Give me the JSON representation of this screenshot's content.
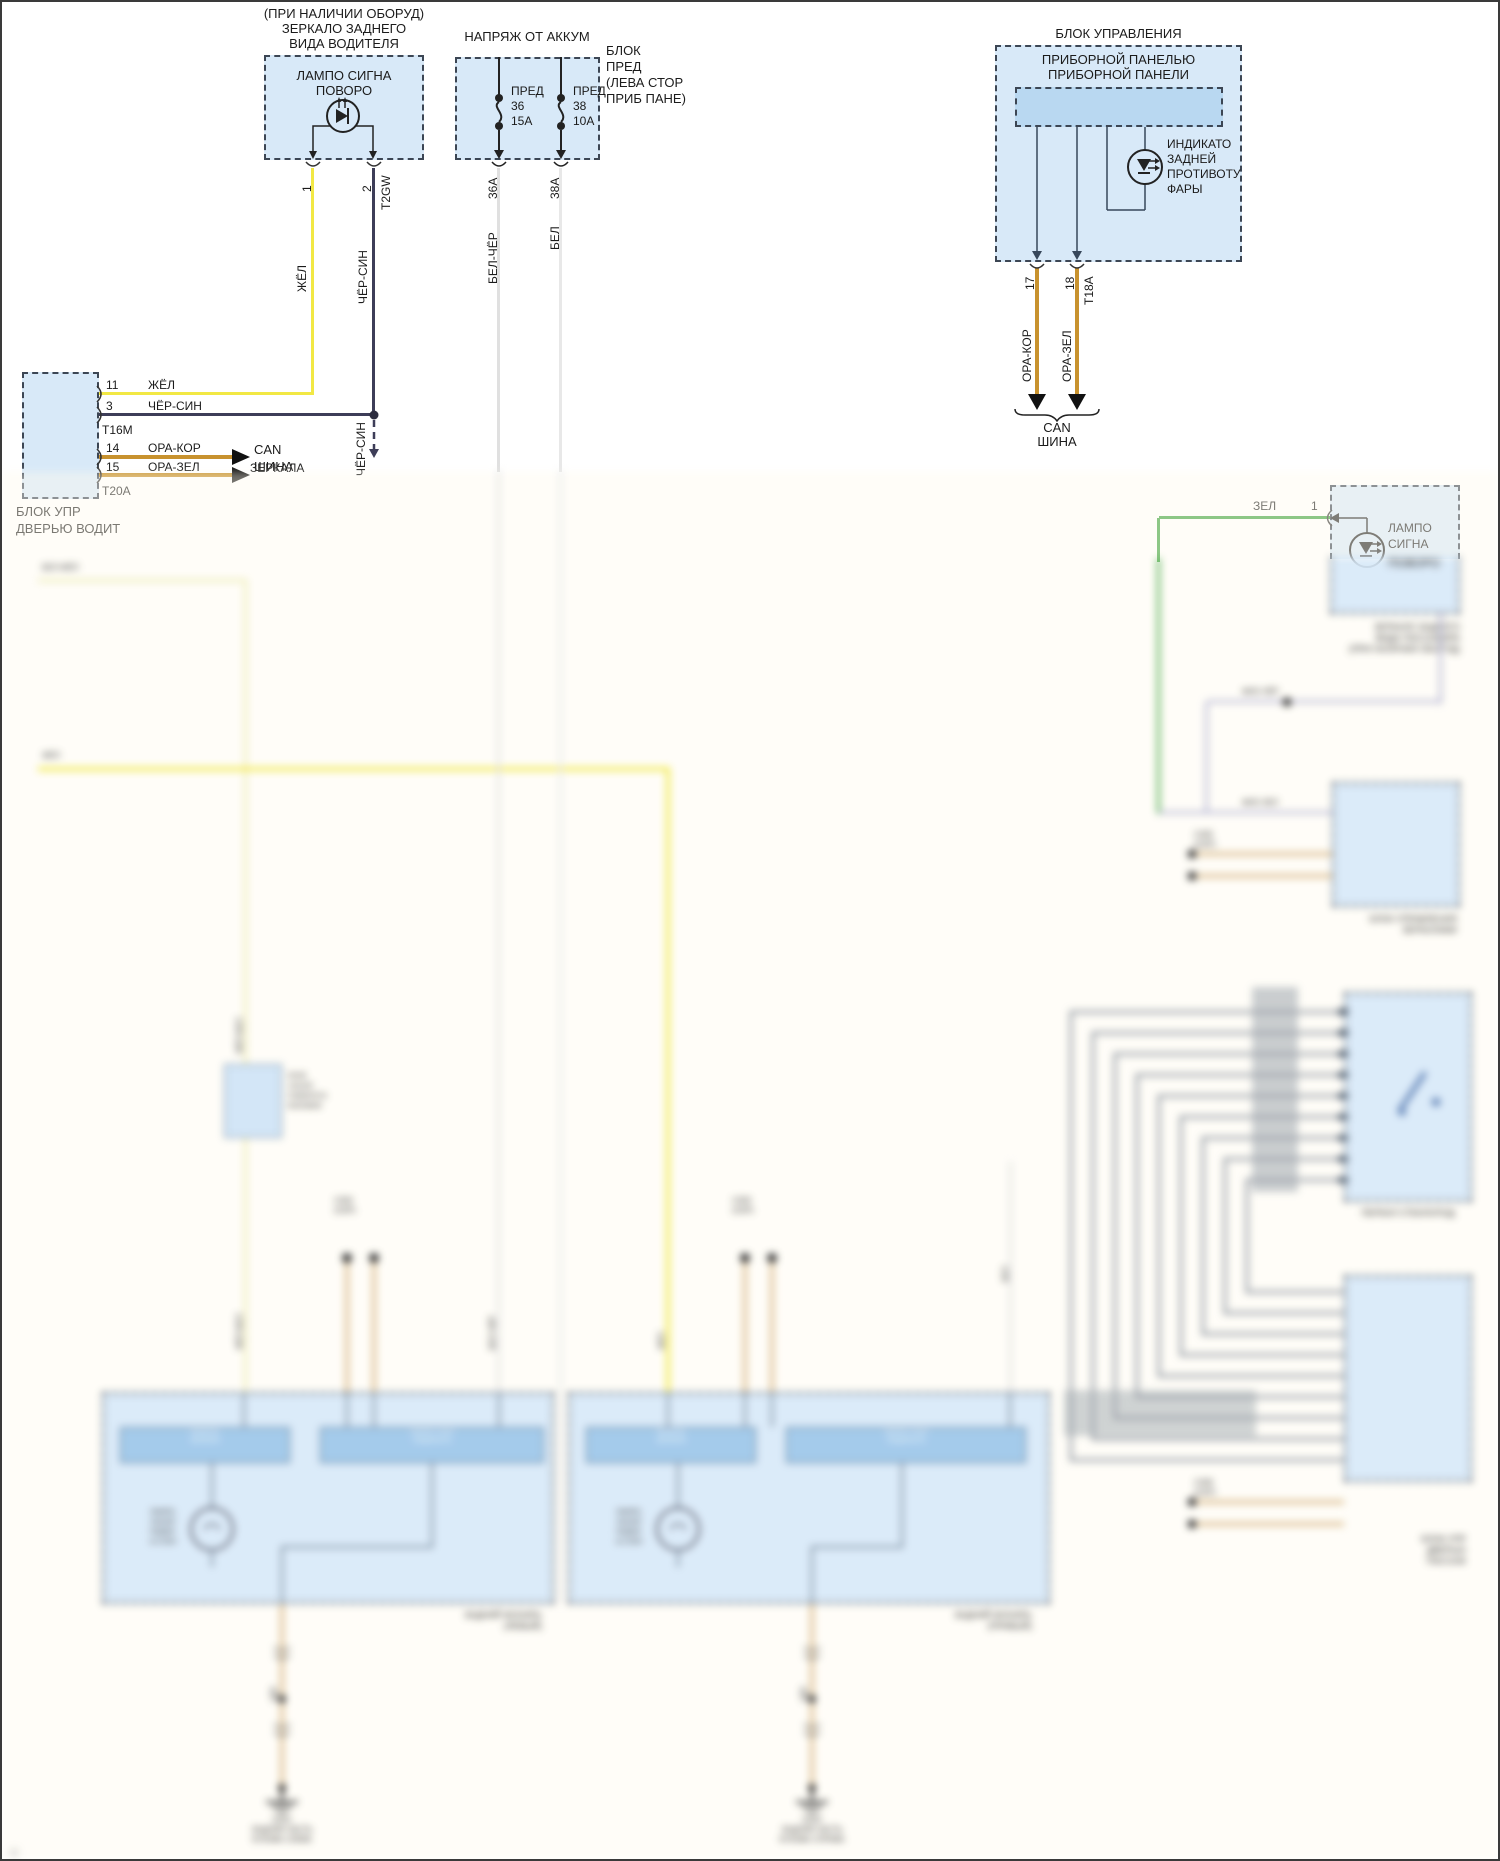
{
  "colors": {
    "module_fill": "#d8e9f8",
    "inner_fill": "#b9d8f1",
    "wire_yellow": "#f2e844",
    "wire_black_blue": "#3d3d58",
    "wire_orange": "#c8922e",
    "wire_white": "#e0e0e0",
    "wire_green": "#3da33d",
    "wire_lavender": "#b4b4d2",
    "wire_tan": "#d9ba8a",
    "wire_gray": "#9aa0a8"
  },
  "top_left_mirror": {
    "caption": [
      "(ПРИ НАЛИЧИИ ОБОРУД)",
      "ЗЕРКАЛО ЗАДНЕГО",
      "ВИДА ВОДИТЕЛЯ"
    ],
    "lamp": [
      "ЛАМПО СИГНА",
      "ПОВОРО"
    ],
    "pin_1": "1",
    "pin_2": "2",
    "connector": "T2GW",
    "wire_yellow": "ЖЁЛ",
    "wire_dark": "ЧЁР-СИН",
    "wire_dark_lower": "ЧЁР-СИН",
    "to_mirror": "ЗЕРКАЛА"
  },
  "driver_door_module": {
    "rows": [
      {
        "pin": "11",
        "wire": "ЖЁЛ"
      },
      {
        "pin": "3",
        "wire": "ЧЁР-СИН"
      },
      {
        "pin": "14",
        "wire": "ОРА-КОР"
      },
      {
        "pin": "15",
        "wire": "ОРА-ЗЕЛ"
      }
    ],
    "connector_top": "Т16М",
    "connector_bottom": "Т20А",
    "can_line1": "CAN",
    "can_line2": "ШИНА",
    "name_line1": "БЛОК УПР",
    "name_line2": "ДВЕРЬЮ ВОДИТ"
  },
  "fuse_box": {
    "title": "НАПРЯЖ ОТ АККУМ",
    "side_note": [
      "БЛОК",
      "ПРЕД",
      "(ЛЕВА СТОР",
      "ПРИБ ПАНЕ)"
    ],
    "fuses": [
      {
        "label": "ПРЕД",
        "number": "36",
        "rating": "15А",
        "pin": "36А",
        "wire_color": "БЕЛ-ЧЁР"
      },
      {
        "label": "ПРЕД",
        "number": "38",
        "rating": "10А",
        "pin": "38А",
        "wire_color": "БЕЛ"
      }
    ]
  },
  "instrument_cluster": {
    "title": "БЛОК УПРАВЛЕНИЯ",
    "subtitle": [
      "ПРИБОРНОЙ ПАНЕЛЬЮ",
      "ПРИБОРНОЙ ПАНЕЛИ"
    ],
    "indicator": [
      "ИНДИКАТО",
      "ЗАДНЕЙ",
      "ПРОТИВОТУ",
      "ФАРЫ"
    ],
    "pin_17": "17",
    "pin_18": "18",
    "connector": "Т18А",
    "wire_17": "ОРА-КОР",
    "wire_18": "ОРА-ЗЕЛ",
    "can_line1": "CAN",
    "can_line2": "ШИНА"
  },
  "passenger_mirror": {
    "wire_green": "ЗЕЛ",
    "pin": "1",
    "lamp_line1": "ЛАМПО",
    "lamp_line2": "СИГНА"
  },
  "blurred_section": {
    "wire1_label": "БЕЛ-ЖЁЛ",
    "wire2_label": "ЖЁЛ",
    "relay_label": [
      "РЕЛЕ",
      "УКАЗАТ",
      "ПОВОРОТА",
      "БОКОВОЕ"
    ],
    "wire_labels": {
      "w1": "ЖЁЛ-БЕЛ",
      "w2": "БЕЛ-ЧЁР",
      "w3": "ЖЁЛ",
      "w4": "БЕЛ"
    },
    "conn_left": [
      "С302",
      "(СЕР)"
    ],
    "conn_right": [
      "С303",
      "(СЕР)"
    ],
    "rear_lamp_left": {
      "bar1": [
        "МОДУЛЬ",
        "ФОНАРЯ"
      ],
      "bar2": [
        "ЛАМПА УКАЗ",
        "ПОВОРОТА"
      ],
      "side": [
        "ЛАМПА",
        "УКАЗАТ",
        "ПОВОР",
        "И СТОП"
      ],
      "name": [
        "ЗАДНИЙ ФОНАРЬ",
        "(ЛЕВЫЙ)"
      ],
      "ground_wire": "ЧЁР",
      "ground": [
        "G401",
        "ЗАДНЯЯ ЧАСТЬ",
        "КУЗОВА СЛЕВА"
      ]
    },
    "rear_lamp_right": {
      "bar1": [
        "МОДУЛЬ",
        "ФОНАРЯ"
      ],
      "bar2": [
        "ЛАМПА УКАЗ",
        "ПОВОРОТА"
      ],
      "side": [
        "ЛАМПА",
        "УКАЗАТ",
        "ПОВОР",
        "И СТОП"
      ],
      "name": [
        "ЗАДНИЙ ФОНАРЬ",
        "(ПРАВЫЙ)"
      ],
      "ground_wire": "ЧЁР",
      "ground": [
        "G402",
        "ЗАДНЯЯ ЧАСТЬ",
        "КУЗОВА СПРАВА"
      ]
    },
    "passenger_mirror_lower": {
      "lamp_line3": "ПОВОРО",
      "name": [
        "ЗЕРКАЛО ЗАДНЕГО",
        "ВИДА ПАССАЖИРА",
        "(ПРИ НАЛИЧИИ ОБОРУД)"
      ],
      "wireA": "ФИО-ЧЁР",
      "wireB": "ФИО-ЗЕЛ"
    },
    "mirror_module": {
      "name": [
        "БЛОК УПРАВЛЕНИЯ",
        "ЗЕРКАЛАМИ"
      ],
      "conn": [
        "С405",
        "(СЕР)"
      ]
    },
    "window_switch": {
      "name": "ПЕРЕКЛ СТЕКЛОПОД"
    },
    "passenger_door_module": {
      "conn": [
        "С406",
        "(СЕР)"
      ],
      "name": [
        "БЛОК УПР",
        "ДВЕРЬЮ",
        "ПАССАЖ"
      ]
    },
    "watermark": "©"
  }
}
